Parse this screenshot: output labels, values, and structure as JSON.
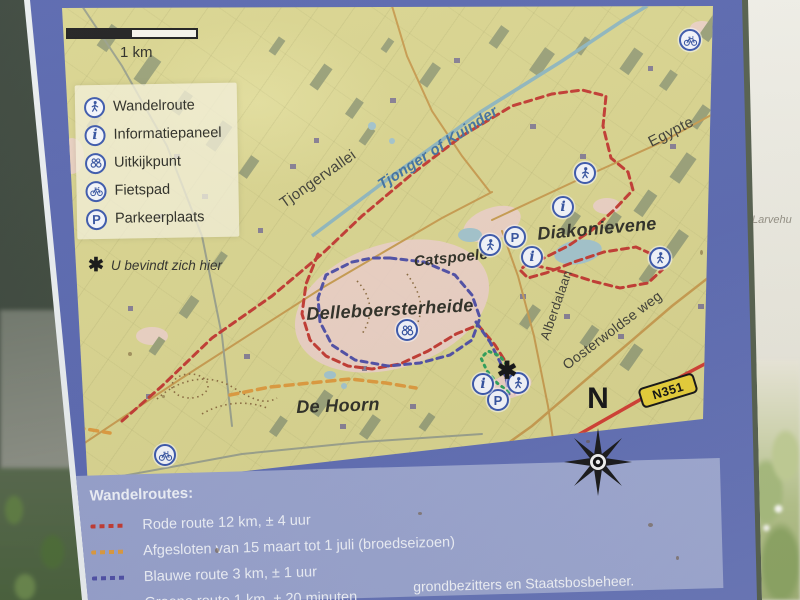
{
  "sign": {
    "map": {
      "scale_label": "1 km",
      "legend": {
        "items": [
          {
            "icon": "wandelroute",
            "label": "Wandelroute"
          },
          {
            "icon": "informatiepaneel",
            "label": "Informatiepaneel"
          },
          {
            "icon": "uitkijkpunt",
            "label": "Uitkijkpunt"
          },
          {
            "icon": "fietspad",
            "label": "Fietspad"
          },
          {
            "icon": "parkeerplaats",
            "label": "Parkeerplaats"
          }
        ],
        "you_are_here_symbol": "✱",
        "you_are_here": "U bevindt zich hier"
      },
      "marker_glyphs": {
        "informatiepaneel": "i",
        "parkeerplaats": "P"
      },
      "place_labels": [
        {
          "id": "tjongervallei",
          "text": "Tjongervallei",
          "x": 256,
          "y": 173,
          "rot": -35,
          "cls": "road",
          "fs": 15
        },
        {
          "id": "tjonger-of-kuinder",
          "text": "Tjonger of Kuinder",
          "x": 376,
          "y": 142,
          "rot": -33,
          "cls": "water",
          "fs": 15
        },
        {
          "id": "egypte",
          "text": "Egypte",
          "x": 609,
          "y": 126,
          "rot": -27,
          "cls": "road",
          "fs": 15
        },
        {
          "id": "diakonievene",
          "text": "Diakonievene",
          "x": 535,
          "y": 223,
          "rot": -5,
          "cls": "area",
          "fs": 18
        },
        {
          "id": "catspoele",
          "text": "Catspoele",
          "x": 389,
          "y": 252,
          "rot": -6,
          "cls": "area",
          "fs": 15
        },
        {
          "id": "alberdalaan",
          "text": "Alberdalaan",
          "x": 494,
          "y": 299,
          "rot": -71,
          "cls": "road",
          "fs": 13
        },
        {
          "id": "oosterwoldse-weg",
          "text": "Oosterwoldse weg",
          "x": 550,
          "y": 324,
          "rot": -37,
          "cls": "road",
          "fs": 14
        },
        {
          "id": "delleboersterheide",
          "text": "Delleboersterheide",
          "x": 328,
          "y": 304,
          "rot": -3,
          "cls": "area",
          "fs": 18
        },
        {
          "id": "de-hoorn",
          "text": "De Hoorn",
          "x": 276,
          "y": 400,
          "rot": -2,
          "cls": "area",
          "fs": 18
        }
      ],
      "markers": [
        {
          "type": "wandelroute",
          "x": 523,
          "y": 167
        },
        {
          "type": "wandelroute",
          "x": 428,
          "y": 239
        },
        {
          "type": "wandelroute",
          "x": 598,
          "y": 252
        },
        {
          "type": "wandelroute",
          "x": 456,
          "y": 377
        },
        {
          "type": "parkeerplaats",
          "x": 453,
          "y": 231
        },
        {
          "type": "parkeerplaats",
          "x": 436,
          "y": 394
        },
        {
          "type": "informatiepaneel",
          "x": 501,
          "y": 201
        },
        {
          "type": "informatiepaneel",
          "x": 470,
          "y": 251
        },
        {
          "type": "informatiepaneel",
          "x": 421,
          "y": 378
        },
        {
          "type": "uitkijkpunt",
          "x": 345,
          "y": 324
        },
        {
          "type": "fietspad",
          "x": 628,
          "y": 34
        },
        {
          "type": "fietspad",
          "x": 103,
          "y": 449
        },
        {
          "type": "you-are-here",
          "x": 445,
          "y": 365
        }
      ],
      "road_badge": "N351",
      "compass_label": "N"
    },
    "routes_legend": {
      "title": "Wandelroutes:",
      "items": [
        {
          "color": "#c23a31",
          "label": "Rode route 12 km, ± 4 uur"
        },
        {
          "color": "#dd9a3d",
          "label": "Afgesloten van 15 maart tot 1 juli (broedseizoen)"
        },
        {
          "color": "#4f4fa5",
          "label": "Blauwe route 3 km, ± 1 uur"
        },
        {
          "color": "#2fa05a",
          "label": "Groene route 1 km, ± 20 minuten"
        }
      ],
      "footnote_partial": "grondbezitters en Staatsbosbeheer."
    }
  },
  "surroundings": {
    "adjacent_panel_text": "Larvehu"
  },
  "colors": {
    "sign_blue": "#5b69b0",
    "legend_panel_blue": "#9aa4cf",
    "map_base": "#d9d48e",
    "water": "#a2c3cb",
    "heath_pink": "#ecd0c7",
    "forest": "#99a077",
    "road_orange": "#c79b4e",
    "road_red": "#d23f33",
    "badge_yellow": "#e7cf38",
    "route_red": "#c23a31",
    "route_orange": "#dd9a3d",
    "route_blue": "#4f4fa5",
    "route_green": "#2fa05a"
  }
}
